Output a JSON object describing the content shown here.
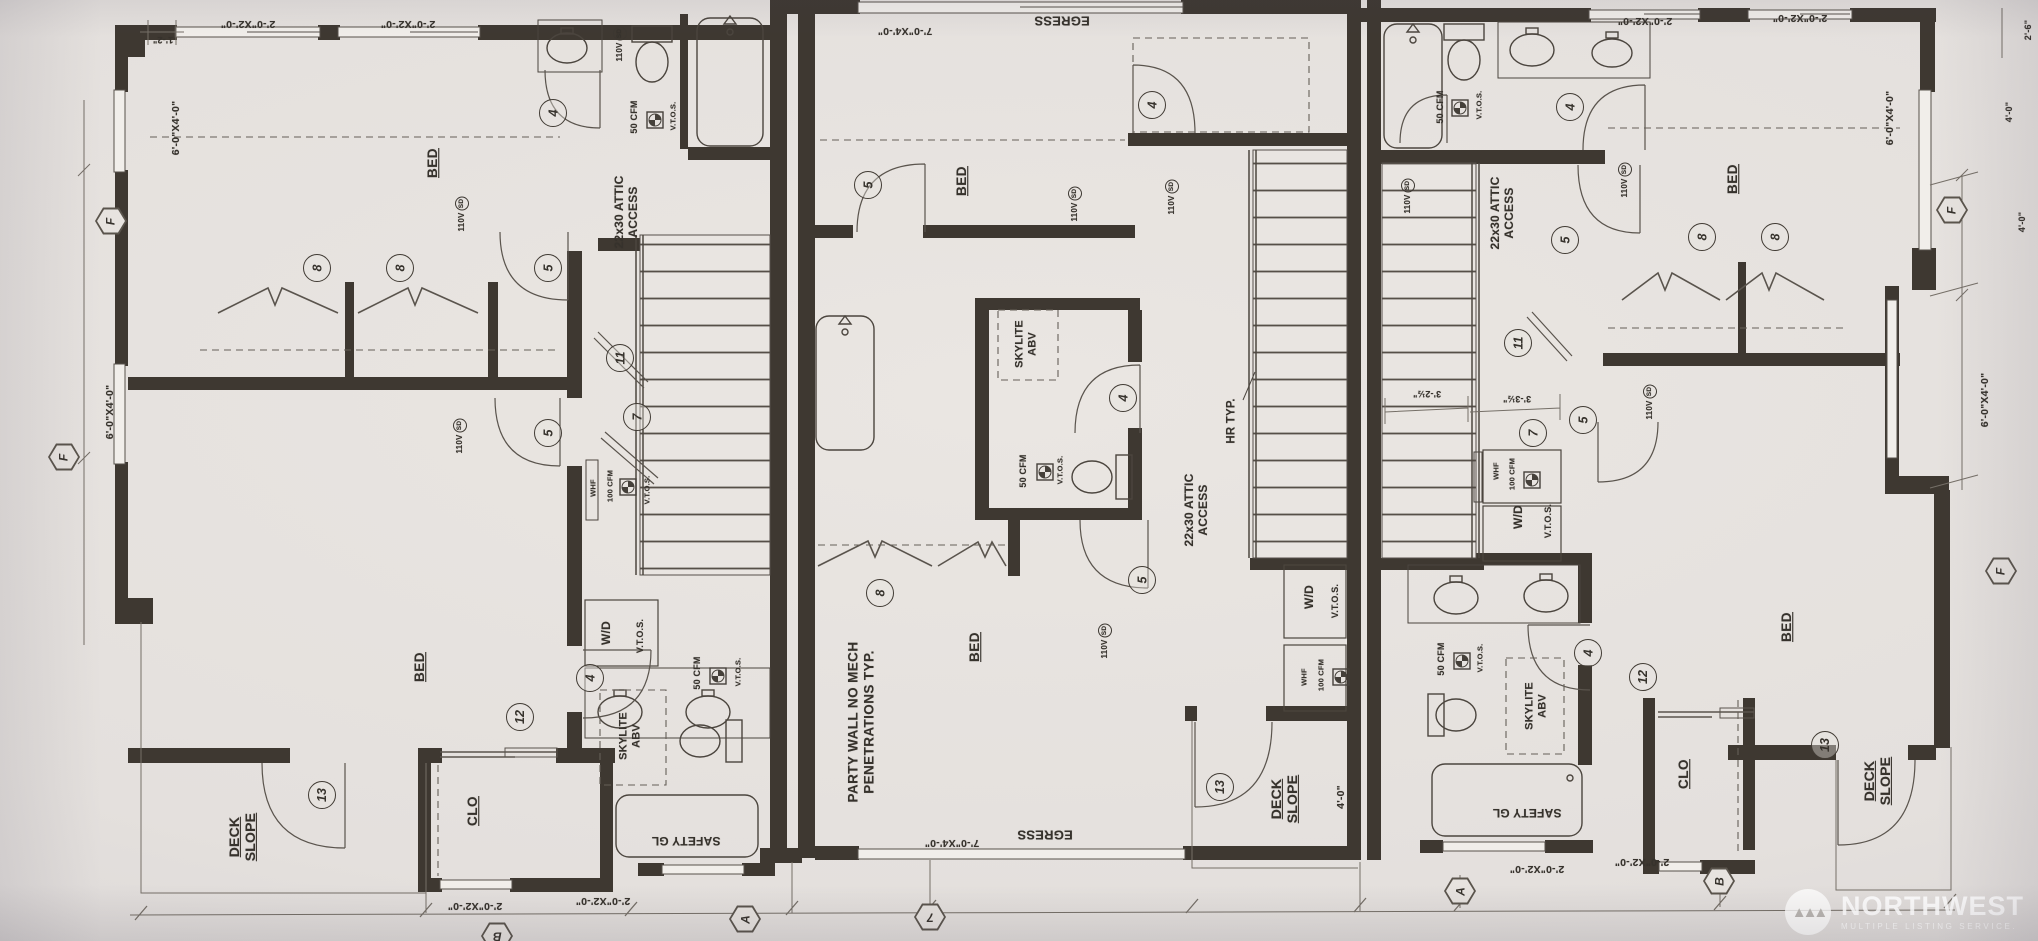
{
  "plan": {
    "rooms": {
      "bed": "BED",
      "clo": "CLO",
      "deck": "DECK",
      "slope": "SLOPE"
    },
    "notes": {
      "egress": "EGRESS",
      "party_wall_1": "PARTY WALL NO MECH",
      "party_wall_2": "PENETRATIONS TYP.",
      "attic_1": "22x30 ATTIC",
      "attic_2": "ACCESS",
      "hr_typ": "HR TYP.",
      "skylite": "SKYLITE",
      "abv": "ABV",
      "safety_gl": "SAFETY GL",
      "wd": "W/D",
      "vtos": "V.T.O.S.",
      "whf": "WHF",
      "cfm50": "50 CFM",
      "cfm100": "100 CFM",
      "v110": "110V",
      "sd": "SD"
    },
    "dims": {
      "w2x2": "2'-0\"X2'-0\"",
      "w7x4": "7'-0\"X4'-0\"",
      "w6x4": "6'-0\"X4'-0\"",
      "d4_0": "4'-0\"",
      "d1_2": "1'-2\"",
      "d2_6": "2'-6\"",
      "d3_2": "3'-2½\"",
      "d3_3": "3'-3½\""
    },
    "door_tags": {
      "t4": "4",
      "t5": "5",
      "t7": "7",
      "t8": "8",
      "t11": "11",
      "t12": "12",
      "t13": "13"
    },
    "window_tags": {
      "a": "A",
      "b": "B",
      "f": "F",
      "n7": "7"
    }
  },
  "watermark": {
    "name": "NORTHWEST",
    "tagline": "MULTIPLE LISTING SERVICE."
  }
}
